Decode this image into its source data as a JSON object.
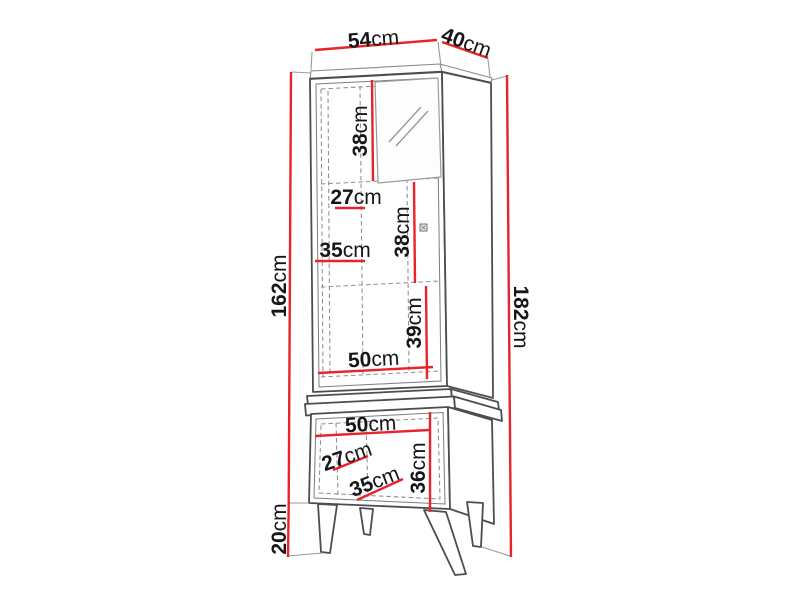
{
  "figure": {
    "kind": "furniture-dimension-diagram",
    "subject": "tall display cabinet with glass door, closed base unit and four tapered legs",
    "unit_system": "cm",
    "accent_color": "#e8232b",
    "outline_color": "#4d4d4d",
    "text_color": "#161616",
    "background": "#ffffff"
  },
  "dims": {
    "top_width": {
      "value": "54",
      "unit": "cm"
    },
    "top_depth": {
      "value": "40",
      "unit": "cm"
    },
    "carcass_height": {
      "value": "162",
      "unit": "cm"
    },
    "leg_height": {
      "value": "20",
      "unit": "cm"
    },
    "total_height": {
      "value": "182",
      "unit": "cm"
    },
    "upper_section_height": {
      "value": "38",
      "unit": "cm"
    },
    "upper_inner_width_a": {
      "value": "27",
      "unit": "cm"
    },
    "upper_inner_width_b": {
      "value": "35",
      "unit": "cm"
    },
    "middle_section_height": {
      "value": "38",
      "unit": "cm"
    },
    "lower_section_height": {
      "value": "39",
      "unit": "cm"
    },
    "upper_inner_width_c": {
      "value": "50",
      "unit": "cm"
    },
    "base_inner_width": {
      "value": "50",
      "unit": "cm"
    },
    "base_inner_a": {
      "value": "27",
      "unit": "cm"
    },
    "base_inner_b": {
      "value": "35",
      "unit": "cm"
    },
    "base_inner_height": {
      "value": "36",
      "unit": "cm"
    }
  }
}
